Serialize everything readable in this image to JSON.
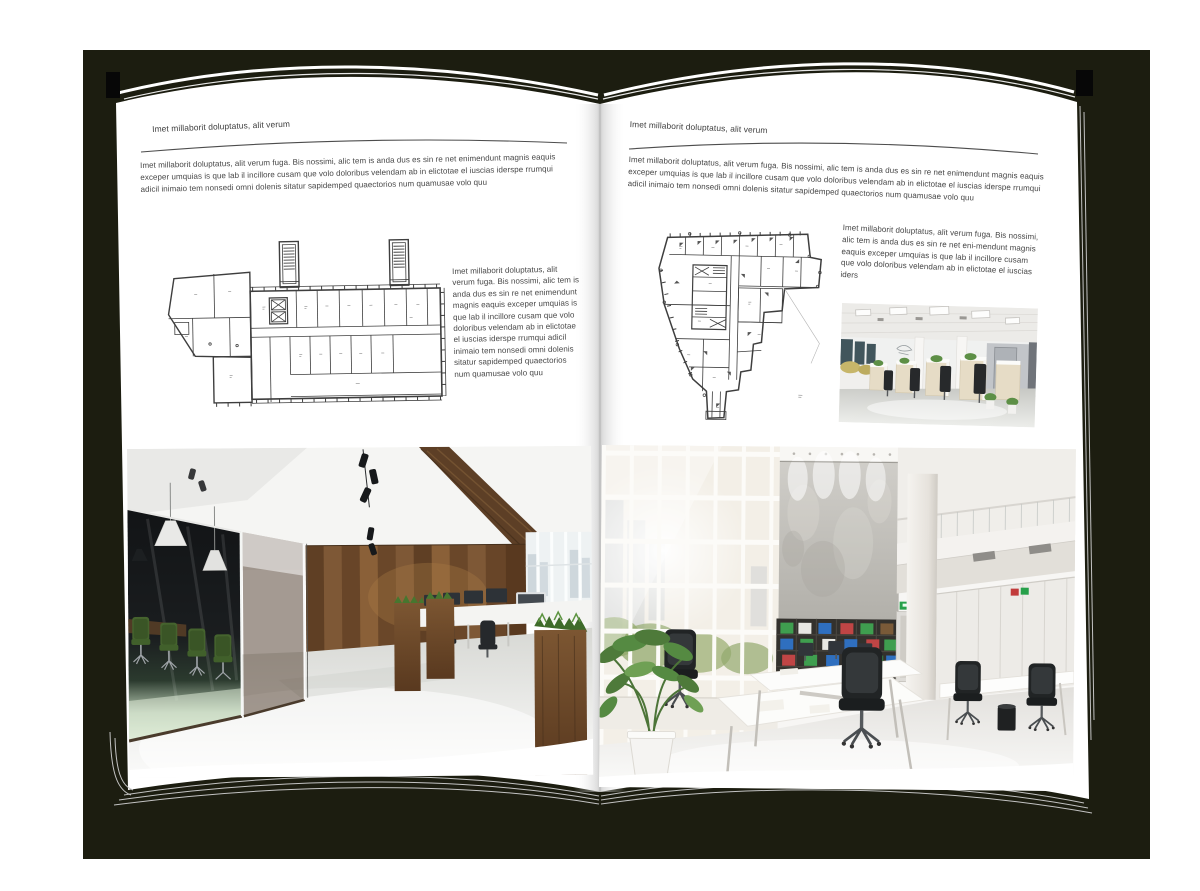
{
  "book": {
    "backdrop_color": "#1c1d10",
    "page_color": "#ffffff",
    "edge_line_color": "#c3c3c3",
    "rule_color": "#4d4d4d"
  },
  "colors": {
    "plan_line": "#3e3e3e",
    "chair_green": "#45632e",
    "wood_brown": "#6b4a2b",
    "binder_green": "#3f9e4f",
    "binder_blue": "#2f6fbf",
    "binder_red": "#c04545",
    "exit_sign_green": "#27a04a"
  },
  "left_page": {
    "header": "Imet millaborit doluptatus, alit verum",
    "intro": "Imet millaborit doluptatus, alit verum fuga. Bis nossimi, alic tem is anda dus es sin re net enimendunt magnis eaquis exceper umquias is que lab il incillore cusam que volo doloribus velendam ab in elictotae el iuscias iderspe rrumqui adicil inimaio tem nonsedi omni dolenis sitatur sapidemped quaectorios num quamusae volo quu",
    "column_text": "Imet millaborit doluptatus, alit verum fuga. Bis nossimi, alic tem is anda dus es sin re net enimendunt magnis eaquis exceper umquias is que lab il incillore cusam que volo doloribus velendam ab in elictotae el iuscias iderspe rrumqui adicil inimaio tem nonsedi omni dolenis sitatur sapidemped quaectorios num quamusae volo quu",
    "floorplan_alt": "floor plan of long rectangular building with two stair towers and angled west wing",
    "photo_alt": "loft office with dark glass meeting room, green chairs, wooden wall and planters"
  },
  "right_page": {
    "header": "Imet millaborit doluptatus, alit verum",
    "intro": "Imet millaborit doluptatus, alit verum fuga. Bis nossimi, alic tem is anda dus es sin re net enimendunt magnis eaquis exceper umquias is que lab il incillore cusam que volo doloribus velendam ab in elictotae el iuscias iderspe rrumqui adicil inimaio tem nonsedi omni dolenis sitatur sapidemped quaectorios num quamusae volo quu",
    "column_text": "Imet millaborit doluptatus, alit verum fuga. Bis nossimi, alic tem is anda dus es sin re net eni-mendunt magnis eaquis exceper umquias is que lab il incillore cusam que volo doloribus velendam ab in elictotae el iuscias iders",
    "floorplan_alt": "irregular tower floor plan tapering to a narrow south stem",
    "photo_small_alt": "open plan office with rows of light wood workstations",
    "photo_large_alt": "double-height white office with concrete wall, binder shelves and glazed facade"
  }
}
